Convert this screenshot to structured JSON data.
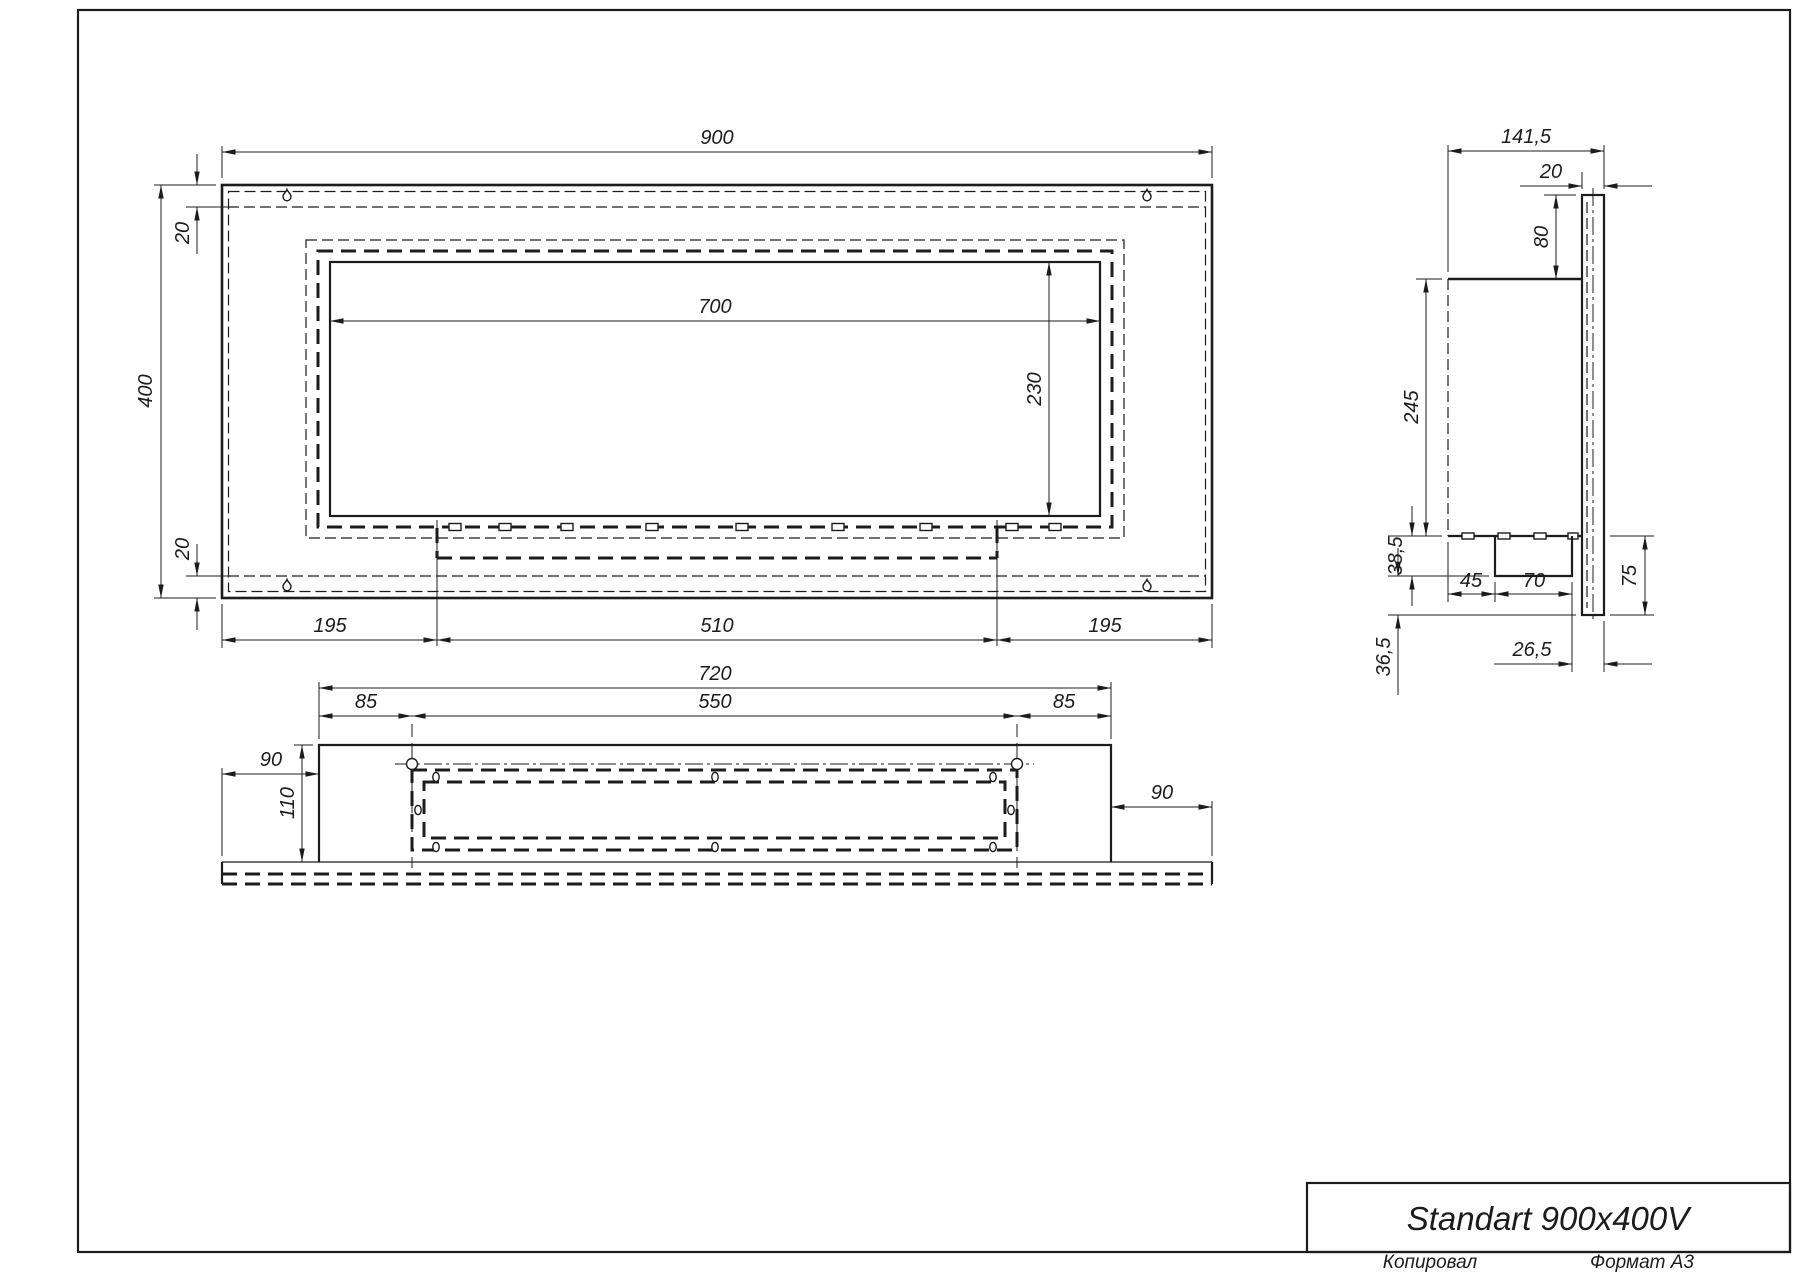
{
  "page": {
    "background": "#ffffff",
    "line_color": "#1c1c1c",
    "icons": {
      "hanger": "keyhole-hanger-icon"
    }
  },
  "title_block": {
    "title": "Standart 900x400V",
    "copied_label": "Копировал",
    "format_label": "Формат А3"
  },
  "front_view": {
    "dims": {
      "width": "900",
      "height": "400",
      "top_inset": "20",
      "bottom_inset": "20",
      "opening_width": "700",
      "opening_height": "230",
      "left_offset": "195",
      "center_span": "510",
      "right_offset": "195"
    }
  },
  "side_view": {
    "dims": {
      "depth": "141,5",
      "panel_thickness": "20",
      "top_height": "80",
      "body_height": "245",
      "burner_height": "38,5",
      "bottom_height": "36,5",
      "lip_height": "75",
      "front_offset": "45",
      "burner_depth": "70",
      "back_offset": "26,5"
    }
  },
  "bottom_view": {
    "dims": {
      "body_width": "720",
      "left_inset": "85",
      "opening_width": "550",
      "right_inset": "85",
      "left_overhang": "90",
      "right_overhang": "90",
      "depth": "110"
    }
  }
}
